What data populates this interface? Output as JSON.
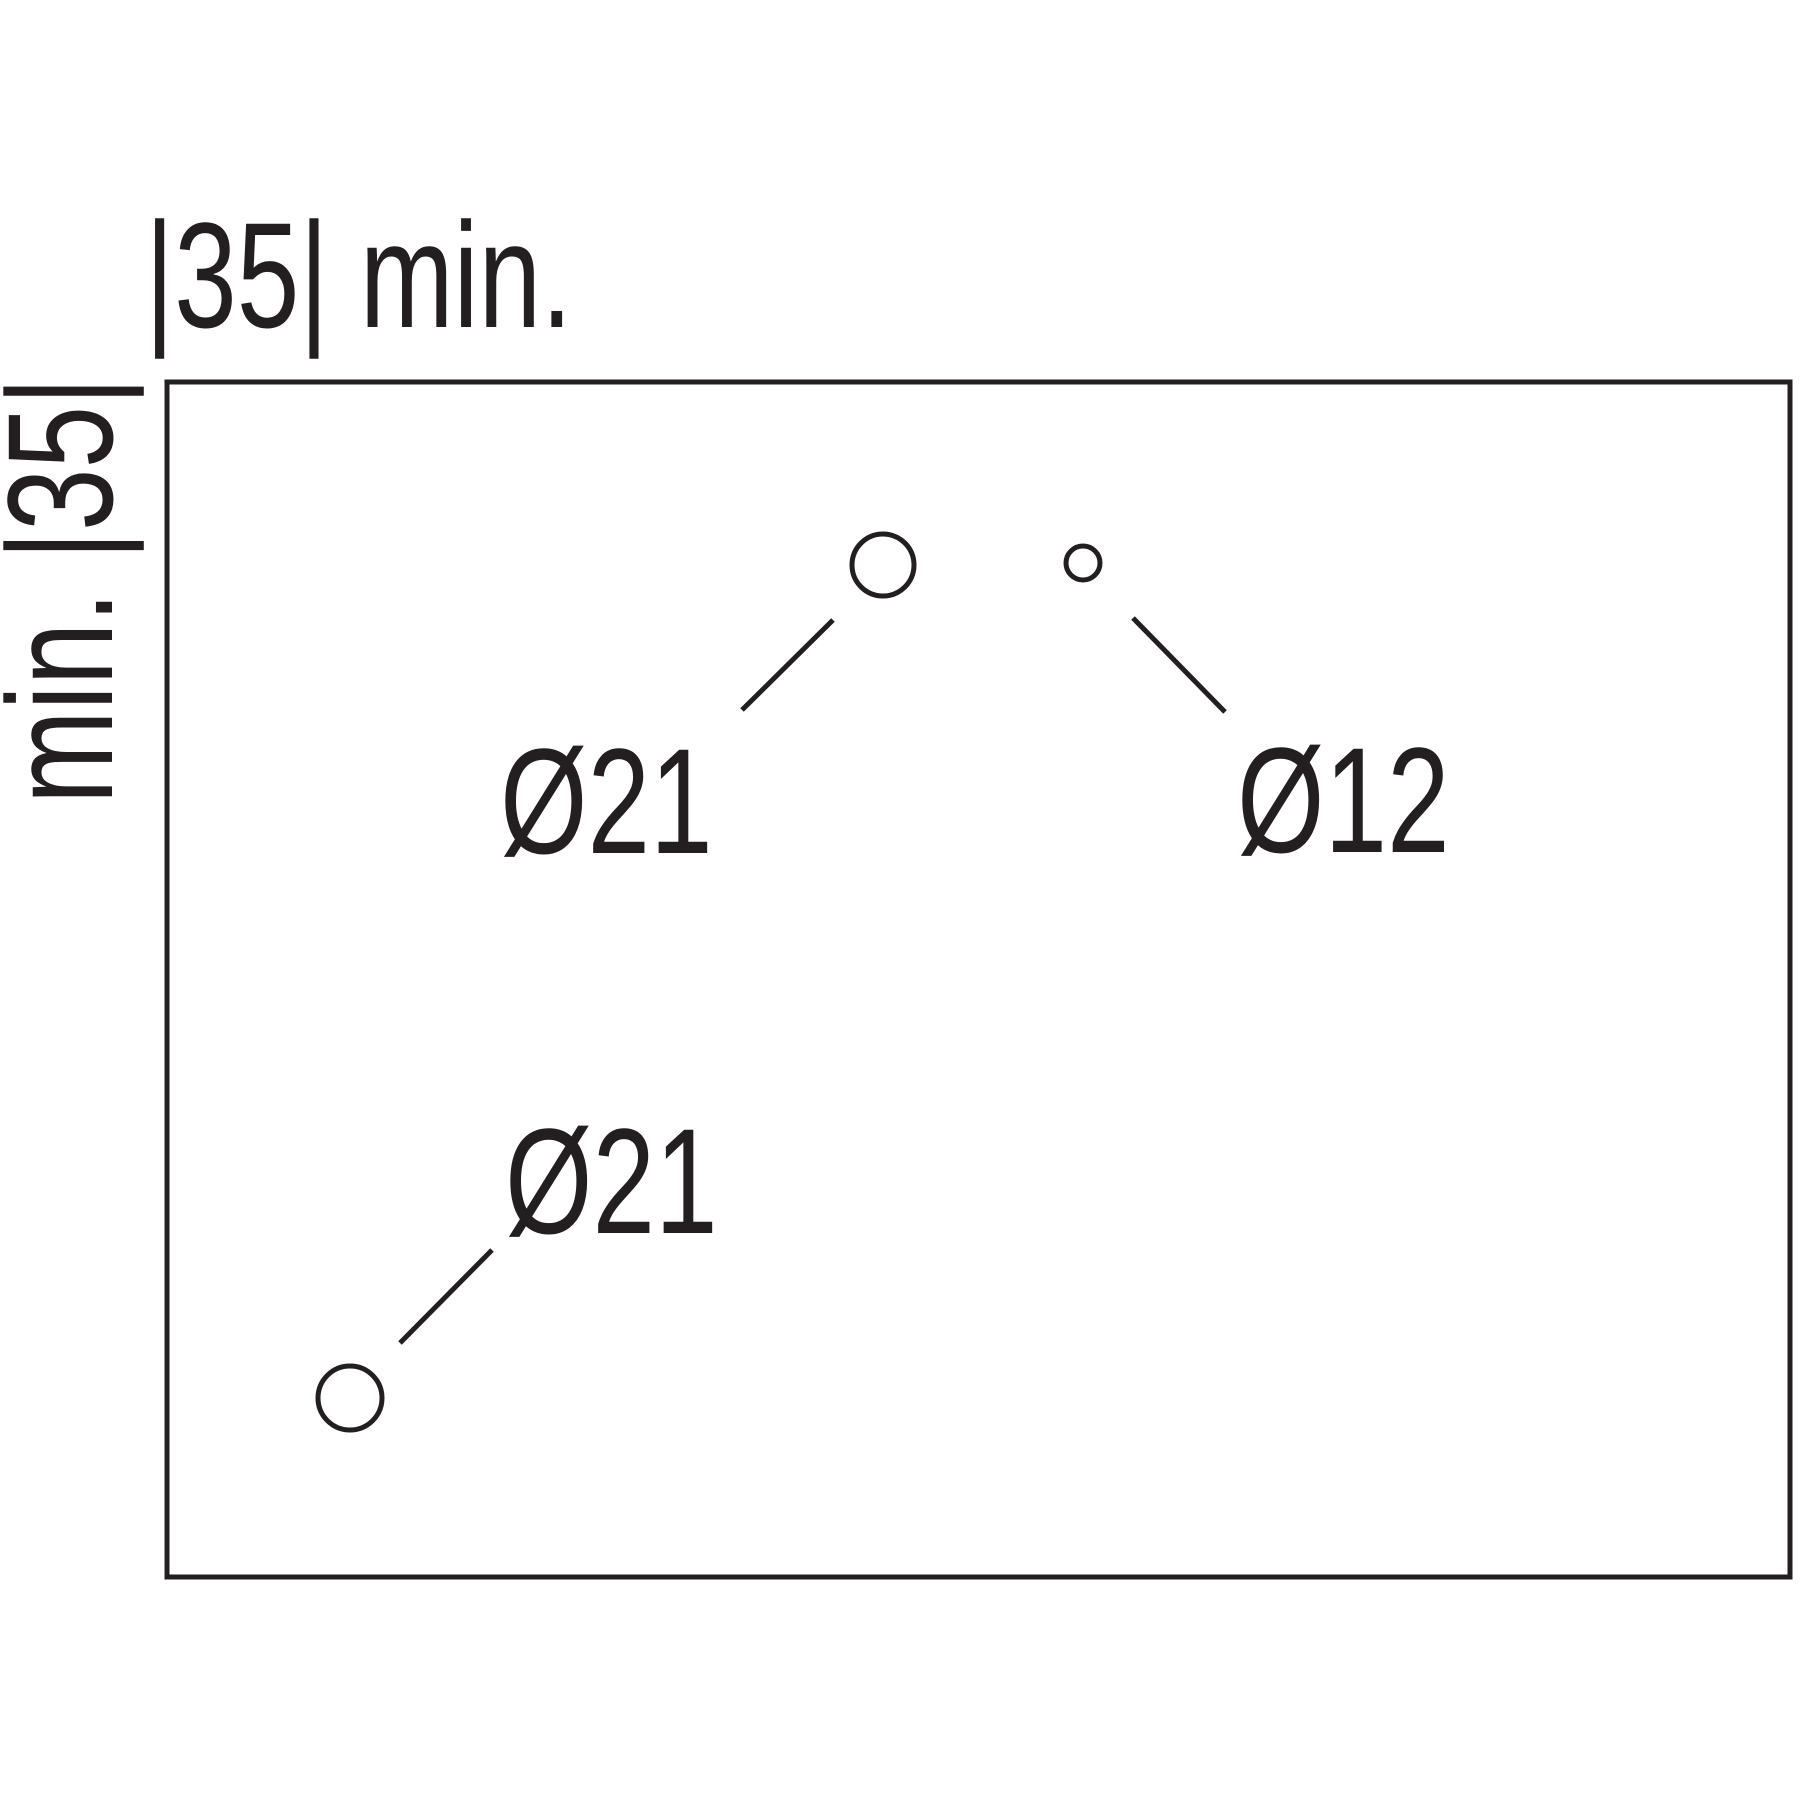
{
  "diagram": {
    "title": "drilling-template-technical-drawing",
    "background_color": "#ffffff",
    "line_color": "#231f20",
    "dimensions": {
      "top_label": "|35| min.",
      "left_label": "min. |35|"
    },
    "holes": [
      {
        "id": "hole-top-left",
        "label": "Ø21",
        "diameter": 21
      },
      {
        "id": "hole-top-right",
        "label": "Ø12",
        "diameter": 12
      },
      {
        "id": "hole-bottom-left",
        "label": "Ø21",
        "diameter": 21
      }
    ]
  }
}
